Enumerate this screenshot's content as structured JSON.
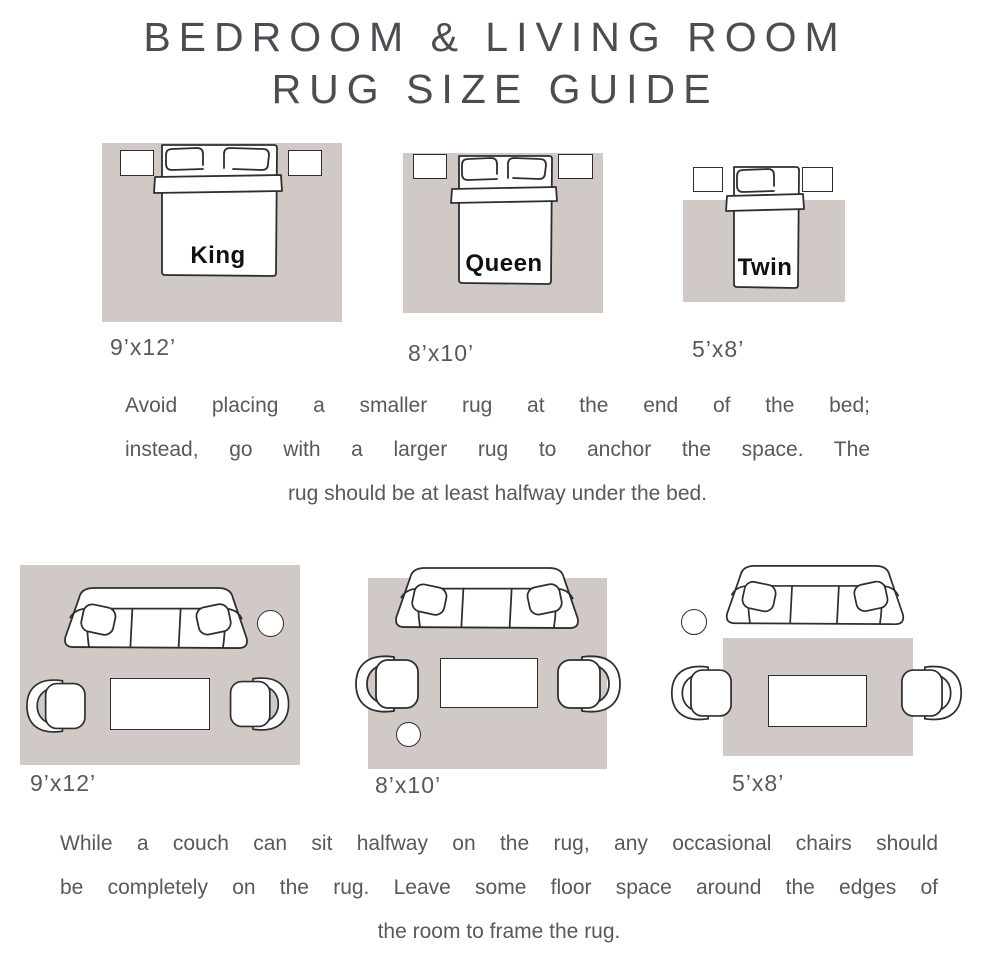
{
  "title": {
    "line1": "BEDROOM & LIVING ROOM",
    "line2": "RUG SIZE GUIDE"
  },
  "colors": {
    "background": "#ffffff",
    "rug": "#d1c9c5",
    "title_text": "#4a4d52",
    "body_text": "#58595b",
    "sketch_line": "#2e2e2e",
    "bed_label_text": "#111111"
  },
  "bedrooms": {
    "items": [
      {
        "bed": "King",
        "size": "9’x12’"
      },
      {
        "bed": "Queen",
        "size": "8’x10’"
      },
      {
        "bed": "Twin",
        "size": "5’x8’"
      }
    ],
    "note_lines": [
      "Avoid placing a smaller rug at the end of the bed;",
      "instead, go with a larger rug to anchor the space. The",
      "rug should be at least halfway under the bed."
    ]
  },
  "living_rooms": {
    "items": [
      {
        "size": "9’x12’"
      },
      {
        "size": "8’x10’"
      },
      {
        "size": "5’x8’"
      }
    ],
    "note_lines": [
      "While a couch can sit halfway on the rug, any occasional chairs should",
      "be completely on the rug. Leave some floor space around the edges of",
      "the room to frame the rug."
    ]
  }
}
